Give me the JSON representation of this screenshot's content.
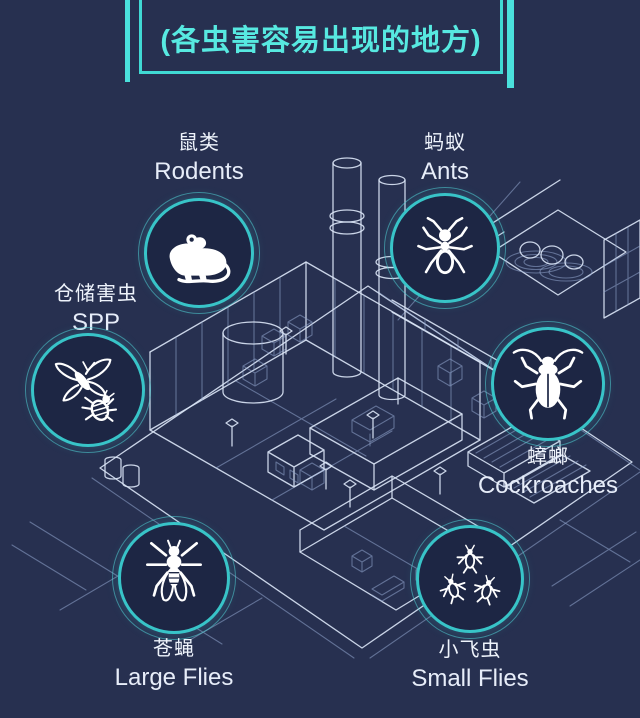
{
  "title": {
    "text": "(各虫害容易出现的地方)",
    "color": "#57e9e1"
  },
  "scene": {
    "description": "isometric factory blueprint wireframe",
    "line_color": "#d8e3f4",
    "background": "#273050"
  },
  "colors": {
    "background": "#273050",
    "circle_fill": "#1d2644",
    "ring": "#38c4c8",
    "accent_cyan": "#4ae0dc",
    "text": "#eef3fb"
  },
  "pests": [
    {
      "id": "rodents",
      "zh": "鼠类",
      "en": "Rodents",
      "icon": "rat-icon",
      "label_position": "above-circle"
    },
    {
      "id": "ants",
      "zh": "蚂蚁",
      "en": "Ants",
      "icon": "ant-icon",
      "label_position": "above-circle"
    },
    {
      "id": "spp",
      "zh": "仓储害虫",
      "en": "SPP",
      "icon": "moth-beetle-icon",
      "label_position": "above-circle"
    },
    {
      "id": "cockroaches",
      "zh": "蟑螂",
      "en": "Cockroaches",
      "icon": "cockroach-icon",
      "label_position": "below-circle"
    },
    {
      "id": "large_flies",
      "zh": "苍蝇",
      "en": "Large Flies",
      "icon": "fly-icon",
      "label_position": "below-circle"
    },
    {
      "id": "small_flies",
      "zh": "小飞虫",
      "en": "Small Flies",
      "icon": "three-flies-icon",
      "label_position": "below-circle"
    }
  ]
}
